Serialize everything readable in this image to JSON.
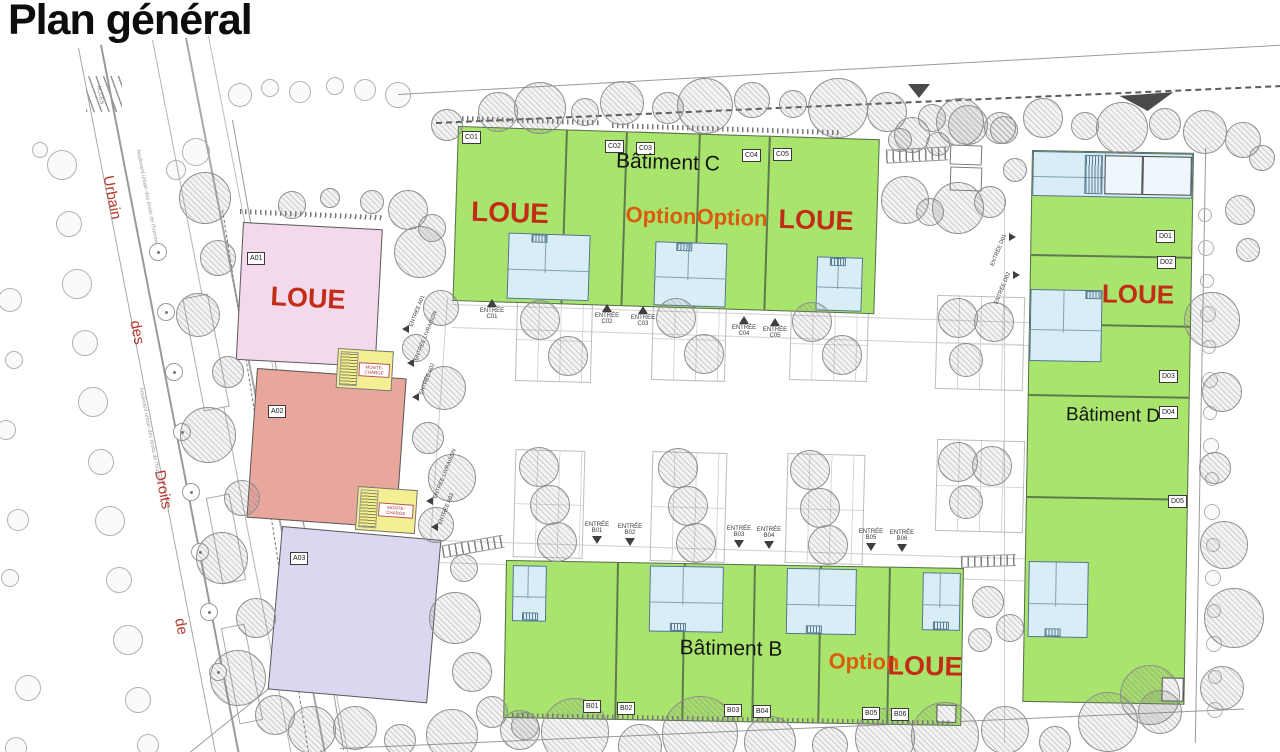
{
  "page": {
    "title": "Plan général"
  },
  "street": {
    "words": [
      "Urbain",
      "des",
      "Droits",
      "de"
    ],
    "caption": "boulevard urbain des droits de l'homme",
    "access_label": "ACCÈS"
  },
  "colors": {
    "available_green": "#a9e46c",
    "office_blue": "#d9edf6",
    "unit_a01_pink": "#f3d9eb",
    "unit_a02_salmon": "#e9a69d",
    "unit_a03_lavender": "#dcd7f1",
    "lift_yellow": "#f4ef92",
    "loue_red": "#c22d18",
    "option_orange": "#da5c0e",
    "street_name_red": "#b6382c"
  },
  "building_a": {
    "units": [
      {
        "id": "A01",
        "status": "LOUE"
      },
      {
        "id": "A02",
        "status": ""
      },
      {
        "id": "A03",
        "status": ""
      }
    ],
    "lift_label": "MONTE-CHARGE"
  },
  "building_c": {
    "label": "Bâtiment C",
    "units": [
      {
        "id": "C01"
      },
      {
        "id": "C02"
      },
      {
        "id": "C03"
      },
      {
        "id": "C04"
      },
      {
        "id": "C05"
      }
    ],
    "annotations": [
      {
        "text": "LOUE",
        "kind": "loue"
      },
      {
        "text": "Option",
        "kind": "option"
      },
      {
        "text": "Option",
        "kind": "option"
      },
      {
        "text": "LOUE",
        "kind": "loue"
      }
    ]
  },
  "building_b": {
    "label": "Bâtiment B",
    "units": [
      {
        "id": "B01"
      },
      {
        "id": "B02"
      },
      {
        "id": "B03"
      },
      {
        "id": "B04"
      },
      {
        "id": "B05"
      },
      {
        "id": "B06"
      }
    ],
    "annotations": [
      {
        "text": "Option",
        "kind": "option"
      },
      {
        "text": "LOUE",
        "kind": "loue"
      }
    ]
  },
  "building_d": {
    "label": "Bâtiment D",
    "units": [
      {
        "id": "D01"
      },
      {
        "id": "D02"
      },
      {
        "id": "D03"
      },
      {
        "id": "D04"
      },
      {
        "id": "D05"
      }
    ],
    "annotations": [
      {
        "text": "LOUE",
        "kind": "loue"
      }
    ]
  },
  "entrances": {
    "c": [
      "ENTRÉE C01",
      "ENTRÉE C02",
      "ENTRÉE C03",
      "ENTRÉE C04",
      "ENTRÉE C05"
    ],
    "b": [
      "ENTRÉE B01",
      "ENTRÉE B02",
      "ENTRÉE B03",
      "ENTRÉE B04",
      "ENTRÉE B05",
      "ENTRÉE B06"
    ],
    "d": [
      "ENTRÉE D01",
      "ENTRÉE D02"
    ],
    "a": [
      "ENTRÉE A01",
      "ENTRÉE LIVRAISON",
      "ENTRÉE A02",
      "ENTRÉE LIVRAISON",
      "ENTRÉE A03"
    ]
  }
}
